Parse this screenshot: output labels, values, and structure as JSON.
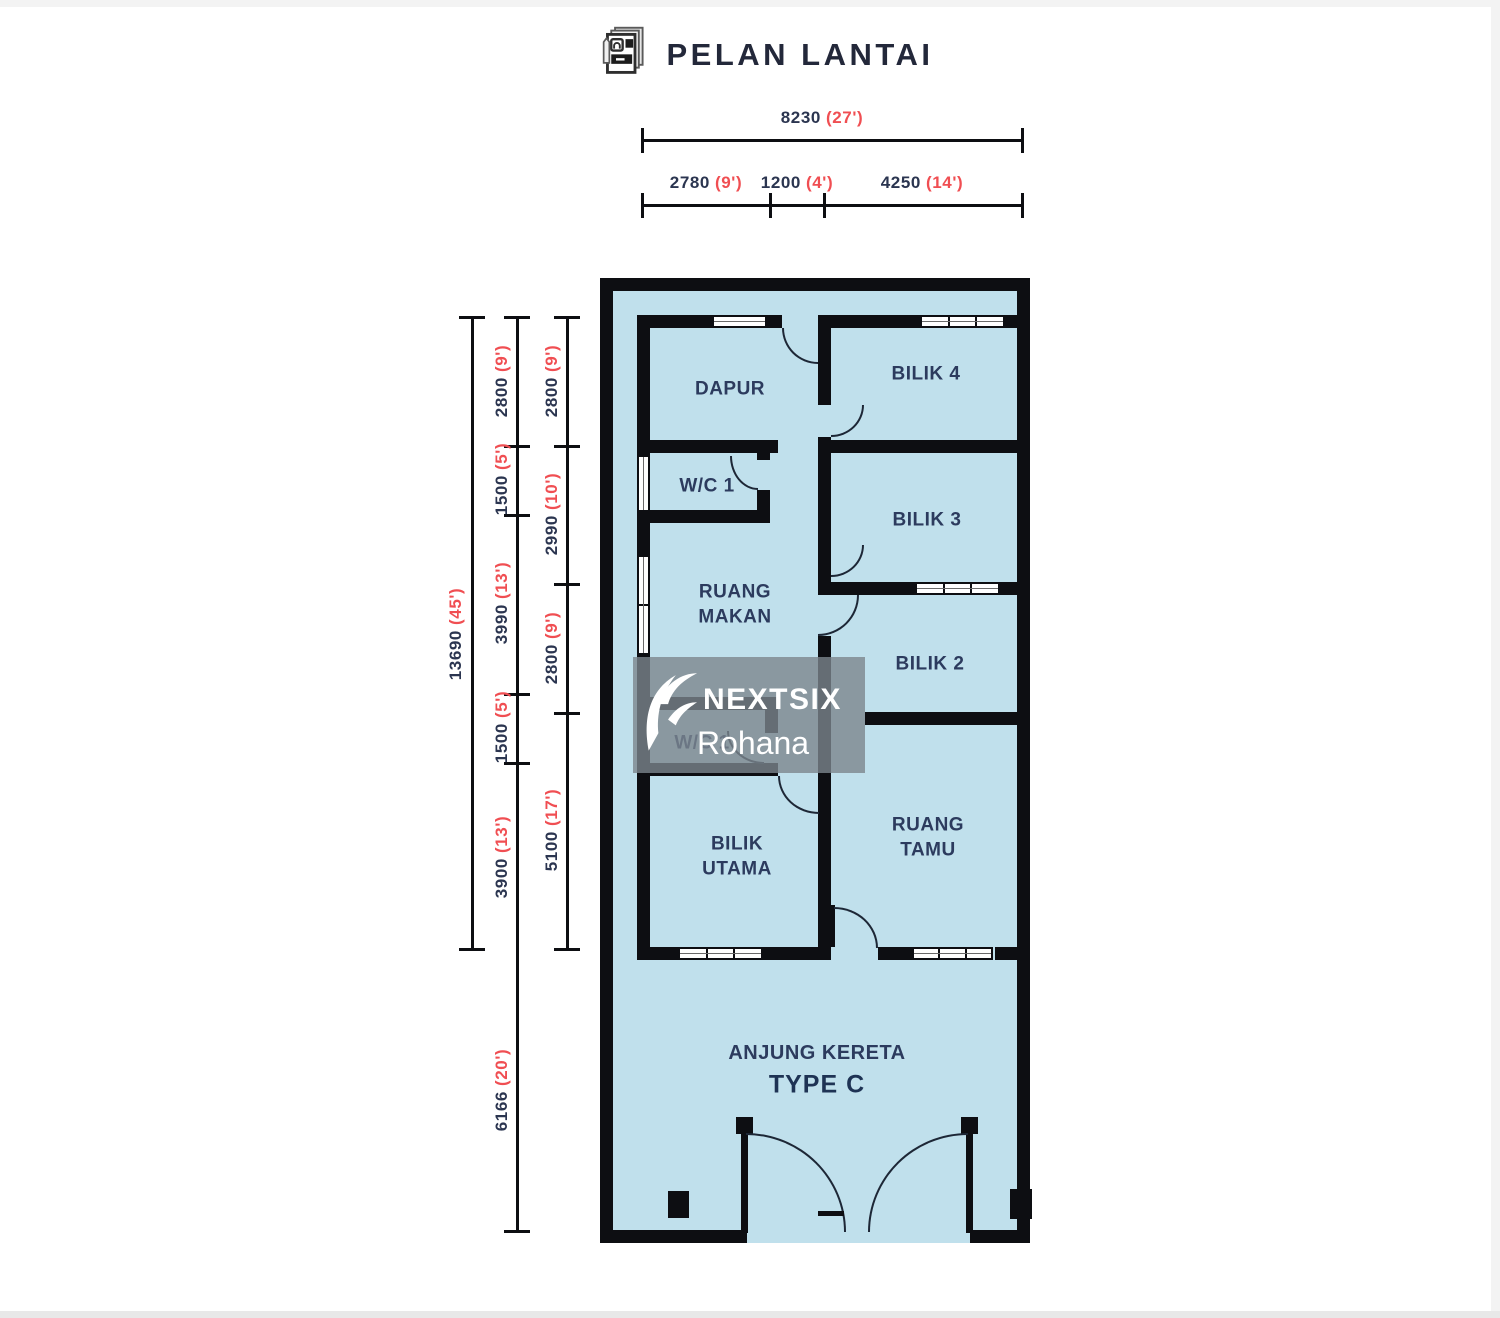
{
  "title": "PELAN LANTAI",
  "type_label": "TYPE C",
  "rooms": {
    "dapur": "DAPUR",
    "bilik4": "BILIK 4",
    "wc1": "W/C 1",
    "bilik3": "BILIK 3",
    "ruang_makan_1": "RUANG",
    "ruang_makan_2": "MAKAN",
    "bilik2": "BILIK 2",
    "wc2": "W/C 1",
    "bilik_utama_1": "BILIK",
    "bilik_utama_2": "UTAMA",
    "ruang_tamu_1": "RUANG",
    "ruang_tamu_2": "TAMU",
    "anjung_kereta": "ANJUNG KERETA"
  },
  "dims": {
    "top_total": {
      "mm": "8230",
      "ft": "(27')"
    },
    "top_segs": [
      {
        "mm": "2780",
        "ft": "(9')"
      },
      {
        "mm": "1200",
        "ft": "(4')"
      },
      {
        "mm": "4250",
        "ft": "(14')"
      }
    ],
    "left_total": {
      "mm": "13690",
      "ft": "(45')"
    },
    "left_mid": [
      {
        "mm": "2800",
        "ft": "(9')"
      },
      {
        "mm": "1500",
        "ft": "(5')"
      },
      {
        "mm": "3990",
        "ft": "(13')"
      },
      {
        "mm": "1500",
        "ft": "(5')"
      },
      {
        "mm": "3900",
        "ft": "(13')"
      },
      {
        "mm": "6166",
        "ft": "(20')"
      }
    ],
    "left_inner": [
      {
        "mm": "2800",
        "ft": "(9')"
      },
      {
        "mm": "2990",
        "ft": "(10')"
      },
      {
        "mm": "2800",
        "ft": "(9')"
      },
      {
        "mm": "5100",
        "ft": "(17')"
      }
    ]
  },
  "watermark": {
    "brand": "NEXTSIX",
    "name": "Rohana"
  },
  "colors": {
    "floor_fill": "#c0e0ec",
    "wall": "#0d0e12",
    "dim_number": "#2b3550",
    "dim_feet_red": "#f04e52",
    "room_label": "#2c3b5e",
    "watermark_grey": "rgba(124,134,141,0.8)"
  }
}
